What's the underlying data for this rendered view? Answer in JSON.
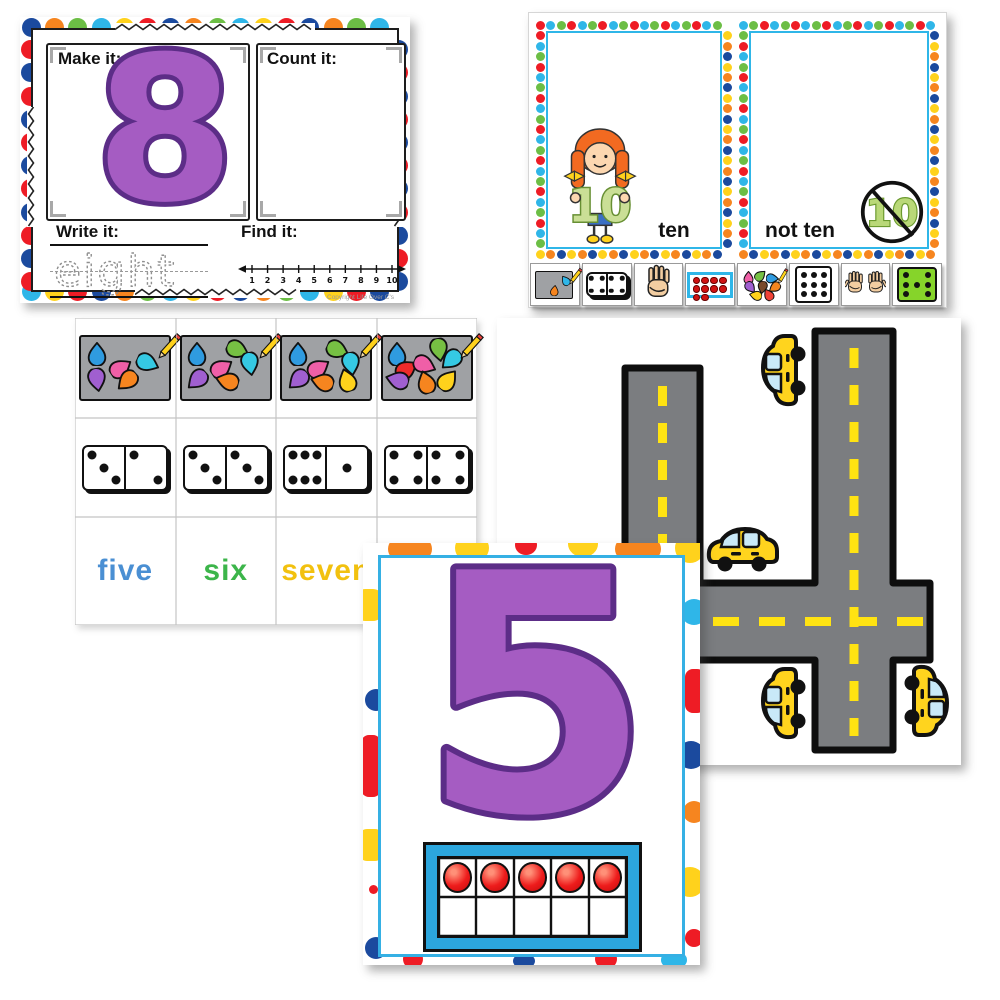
{
  "palette": {
    "red": "#ee1c25",
    "blue": "#1b4a9e",
    "orange": "#f6851f",
    "green": "#6cbe45",
    "cyan": "#2fb6e8",
    "yellow": "#ffd21c",
    "purple": "#a55cc2",
    "purple_dark": "#5c2d87",
    "road_gray": "#7b7d80",
    "dash_yellow": "#ffe312",
    "car_yellow": "#ffd41e",
    "window_blue": "#c9e9f8",
    "frame_blue": "#35b0e4",
    "counter_red": "#e81515",
    "die_green": "#86d42a",
    "ten_green": "#cadf96",
    "ten_green_dark": "#678f33",
    "skin": "#f2cda1",
    "hair_orange": "#f26a21",
    "mat_gray": "#9fa1a4",
    "pink": "#ef5fa7",
    "violet": "#a05fd0"
  },
  "worksheet8": {
    "make_label": "Make it:",
    "count_label": "Count it:",
    "write_label": "Write it:",
    "find_label": "Find it:",
    "big_number": "8",
    "trace_word": "eight",
    "number_line_ticks": [
      "1",
      "2",
      "3",
      "4",
      "5",
      "6",
      "7",
      "8",
      "9",
      "10"
    ],
    "copyright": "Copyright Life Over C's"
  },
  "ten_sort": {
    "ten_label": "ten",
    "not_ten_label": "not ten",
    "girl_number": "10",
    "crossed_number": "10",
    "mini_cards": [
      {
        "name": "work-mat"
      },
      {
        "name": "domino",
        "pips": [
          4,
          4
        ]
      },
      {
        "name": "hand-four",
        "fingers": 4
      },
      {
        "name": "ten-frame",
        "filled": 10
      },
      {
        "name": "eraser-pile",
        "count": 8
      },
      {
        "name": "nine-dot-card",
        "dots": 9
      },
      {
        "name": "two-hands",
        "fingers": 10
      },
      {
        "name": "seven-dot-die",
        "dots": 7
      }
    ]
  },
  "counting_grid": {
    "columns": [
      {
        "erasers": 5,
        "eraser_colors": [
          "#2f9be0",
          "#ef5fa7",
          "#35c9e3",
          "#a05fd0",
          "#f6851f"
        ],
        "domino": [
          3,
          2
        ],
        "word": "five",
        "word_color": "#4a8fd3"
      },
      {
        "erasers": 6,
        "eraser_colors": [
          "#2f9be0",
          "#ef5fa7",
          "#76c043",
          "#35c9e3",
          "#a05fd0",
          "#f6851f"
        ],
        "domino": [
          3,
          3
        ],
        "word": "six",
        "word_color": "#3cb54a"
      },
      {
        "erasers": 7,
        "eraser_colors": [
          "#2f9be0",
          "#ef5fa7",
          "#76c043",
          "#35c9e3",
          "#a05fd0",
          "#f6851f",
          "#ffd21c"
        ],
        "domino": [
          6,
          1
        ],
        "word": "seven",
        "word_color": "#f2c10f"
      },
      {
        "erasers": 8,
        "eraser_colors": [
          "#2f9be0",
          "#ee2b2b",
          "#ef5fa7",
          "#76c043",
          "#35c9e3",
          "#a05fd0",
          "#f6851f",
          "#ffd21c"
        ],
        "domino": [
          4,
          4
        ],
        "word": "",
        "word_color": "#f2c10f"
      }
    ]
  },
  "road_four": {
    "big_number": "4",
    "car_count": 4
  },
  "five_card": {
    "big_number": "5",
    "ten_frame": {
      "cols": 5,
      "rows": 2,
      "filled": 5
    }
  }
}
